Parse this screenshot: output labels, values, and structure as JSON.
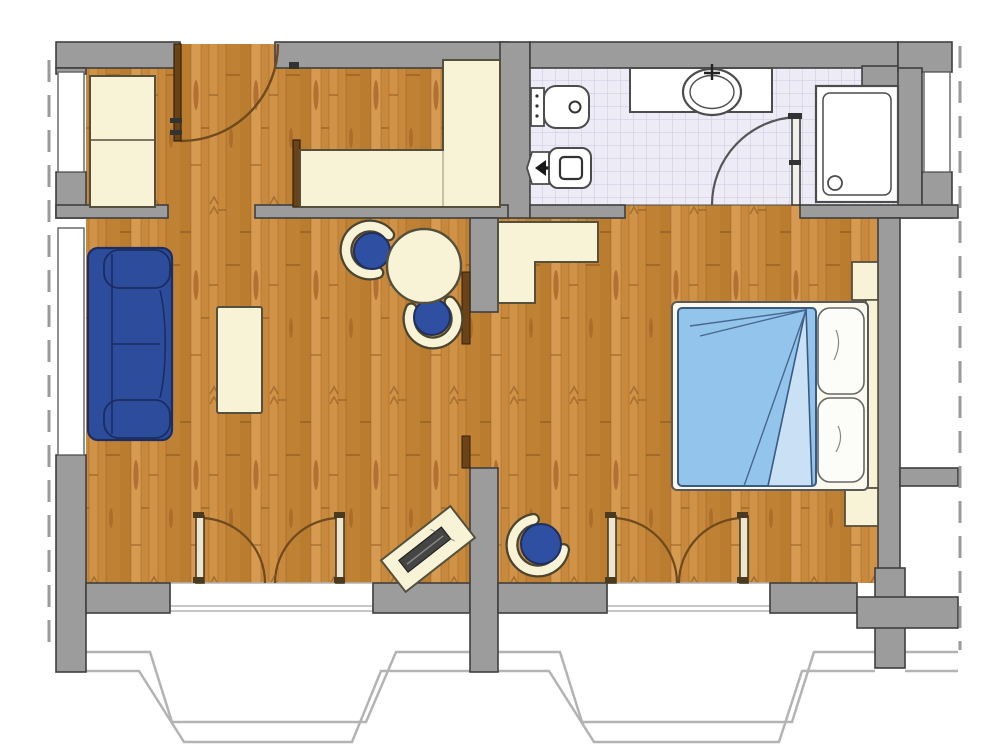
{
  "image_type": "architectural floor plan (no text labels visible)",
  "colors": {
    "white": "#ffffff",
    "wall": "#9c9c9c",
    "wall_line": "#3f3f3f",
    "wood": "#c8893c",
    "wood_dark": "#ae7226",
    "wood_light": "#dca258",
    "knot": "#8d4716",
    "cream": "#f8f3d7",
    "cream_line": "#55503c",
    "sofa": "#2d4c9b",
    "sofa_line": "#1b2d62",
    "chair": "#2f4fa3",
    "bed": "#93c4ec",
    "bed_fold": "#c9e0f5",
    "bed_line": "#3a5a80",
    "pillow": "#fcfcf8",
    "tile": "#edecf6",
    "tile_line": "#c9c7de",
    "line": "#4c4c4c",
    "door": "#6b4318",
    "door_light": "#ece5d2",
    "arc": "#6f4a1f",
    "dash": "#9a9a9a",
    "bay": "#b3b3b3",
    "laptop": "#454545"
  },
  "legend": {
    "areas": [
      "hallway",
      "bathroom",
      "living-dining-area",
      "sleeping-area",
      "balcony-bay-windows"
    ],
    "furniture": [
      "hall-wardrobe",
      "built-in-counter",
      "sofa",
      "coffee-table",
      "round-dining-table",
      "dining-chair",
      "desk",
      "laptop",
      "desk-chair",
      "double-bed",
      "duvet",
      "pillows",
      "headboard-shelf",
      "nightstand",
      "bedroom-cabinet"
    ],
    "fixtures": [
      "toilet",
      "bidet",
      "vanity-counter",
      "oval-sink",
      "shower-tray"
    ],
    "openings": [
      "entrance-door",
      "hall-door-leaf",
      "bathroom-door",
      "sliding-door-leaves",
      "french-balcony-doors",
      "window-niches",
      "roof-overhang-dashed-line"
    ]
  }
}
